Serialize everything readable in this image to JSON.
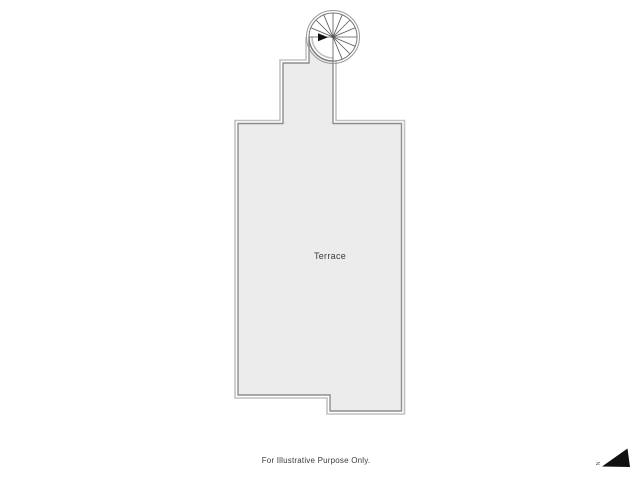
{
  "window": {
    "background": "#ffffff"
  },
  "floor_plan": {
    "room_label": "Terrace",
    "disclaimer": "For Illustrative Purpose Only.",
    "north_marker_label": "N"
  },
  "icons": {
    "spiral_staircase": "circle-with-radial-treads-and-entry-arrow",
    "north_arrow": "filled-triangle-pointing-upper-right"
  },
  "colors": {
    "bg": "#ffffff",
    "floor_fill": "#ececec",
    "wall_dark": "#8d8d8d",
    "wall_light": "#c2c2c2",
    "stair_line": "#555555",
    "ink": "#3a3a3a",
    "arrow": "#111111"
  }
}
